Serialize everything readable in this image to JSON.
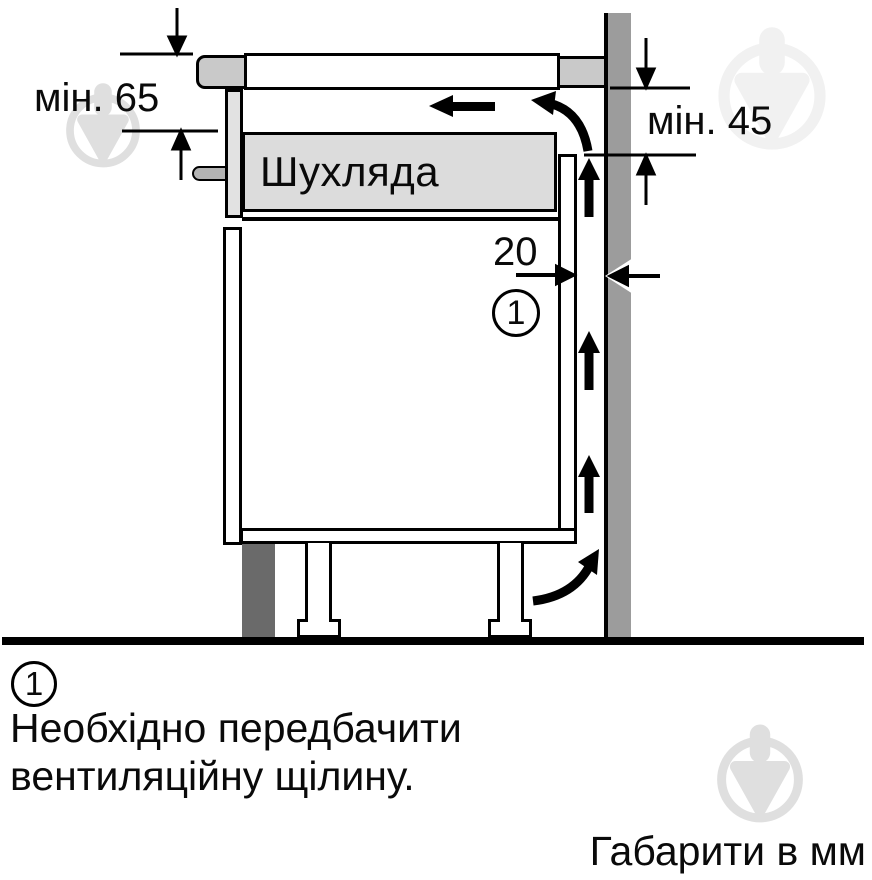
{
  "figure": {
    "dimensions": {
      "top_left_min": "мін. 65",
      "top_right_min": "мін. 45",
      "rear_gap": "20"
    },
    "drawer_label": "Шухляда",
    "callout_number": "1",
    "note": {
      "number": "1",
      "line1": "Необхідно передбачити",
      "line2": "вентиляційну щілину."
    },
    "caption": "Габарити в мм",
    "icons": {
      "watermark": "pin-drop-watermark-icon",
      "airflow": "airflow-arrow-icon"
    },
    "colors": {
      "wall": "#9c9c9c",
      "hob-trim": "#c9c9c9",
      "side-plate": "#e2e2e2",
      "peg": "#b3b3b3",
      "drawer": "#dcdcdc",
      "plinth": "#6a6a6a",
      "outline": "#000000",
      "watermark": "#dfdfdf",
      "watermark-faint": "#f1f1f1"
    }
  }
}
